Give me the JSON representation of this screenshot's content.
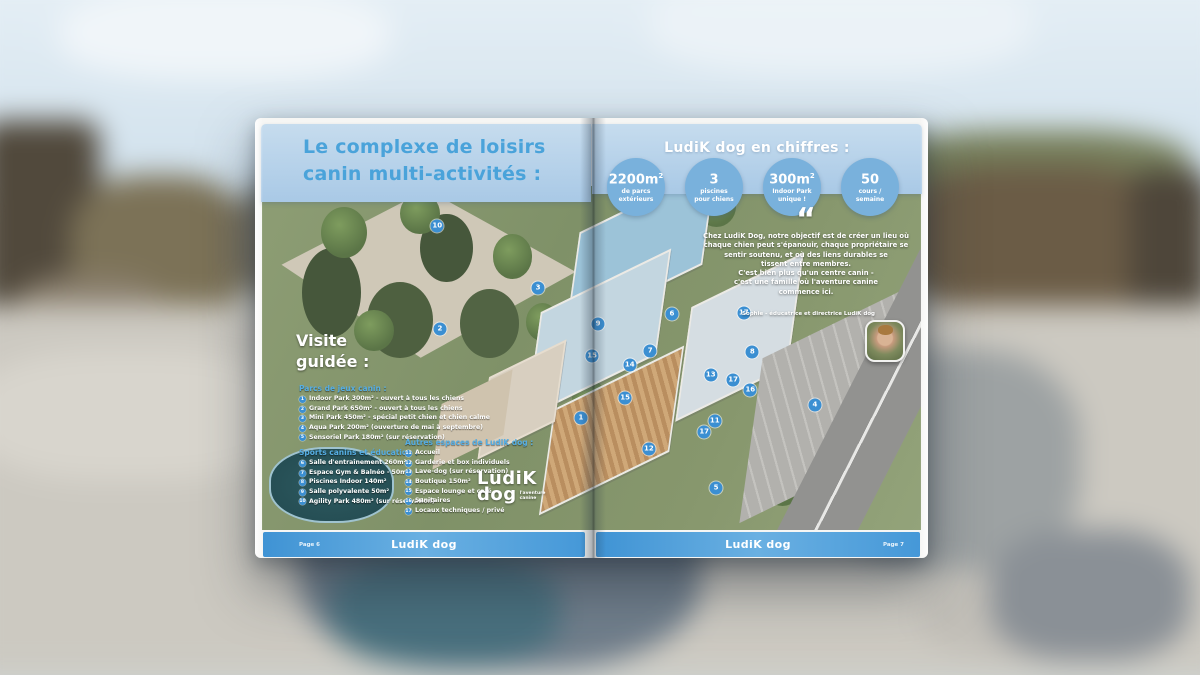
{
  "background": {
    "description": "blurred outdoor courtyard with fences and gravel ground"
  },
  "brochure": {
    "left_page": {
      "title_line1": "Le complexe de loisirs",
      "title_line2": "canin multi-activités :",
      "visite_heading_line1": "Visite",
      "visite_heading_line2": "guidée :",
      "parcs": {
        "title": "Parcs de jeux canin :",
        "items": [
          {
            "num": "1",
            "label": "Indoor Park 300m² - ouvert à tous les chiens"
          },
          {
            "num": "2",
            "label": "Grand Park 650m² - ouvert à tous les chiens"
          },
          {
            "num": "3",
            "label": "Mini Park 450m² - spécial petit chien et chien calme"
          },
          {
            "num": "4",
            "label": "Aqua Park 200m² (ouverture de mai à septembre)"
          },
          {
            "num": "5",
            "label": "Sensoriel Park 180m² (sur réservation)"
          }
        ]
      },
      "sports": {
        "title": "Sports canins et éducation :",
        "items": [
          {
            "num": "6",
            "label": "Salle d'entraînement 260m²"
          },
          {
            "num": "7",
            "label": "Espace Gym & Balnéo - 50m²"
          },
          {
            "num": "8",
            "label": "Piscines Indoor 140m²"
          },
          {
            "num": "9",
            "label": "Salle polyvalente 50m²"
          },
          {
            "num": "10",
            "label": "Agility Park 480m² (sur réservation)"
          }
        ]
      },
      "autres": {
        "title": "Autres espaces de LudiK dog :",
        "items": [
          {
            "num": "11",
            "label": "Accueil"
          },
          {
            "num": "12",
            "label": "Garderie et box individuels"
          },
          {
            "num": "13",
            "label": "Lave-dog (sur réservation)"
          },
          {
            "num": "14",
            "label": "Boutique 150m²"
          },
          {
            "num": "15",
            "label": "Espace lounge et café"
          },
          {
            "num": "16",
            "label": "Sanitaires"
          },
          {
            "num": "17",
            "label": "Locaux techniques / privé"
          }
        ]
      },
      "footer": {
        "page_label": "Page 6",
        "brand": "LudiK dog"
      }
    },
    "right_page": {
      "heading": "LudiK dog en chiffres :",
      "stats": [
        {
          "value": "2200m",
          "sup": "2",
          "label": "de parcs\nextérieurs"
        },
        {
          "value": "3",
          "sup": "",
          "label": "piscines\npour chiens"
        },
        {
          "value": "300m",
          "sup": "2",
          "label": "Indoor Park\nunique !"
        },
        {
          "value": "50",
          "sup": "",
          "label": "cours /\nsemaine"
        }
      ],
      "quote": {
        "mark": "“",
        "lines": [
          {
            "text": "Chez LudiK Dog, notre objectif est de créer un lieu où"
          },
          {
            "text": "chaque chien peut s'épanouir, chaque propriétaire se"
          },
          {
            "text": "sentir soutenu, et où des liens durables se"
          },
          {
            "text": "tissent entre membres."
          },
          {
            "text": "C'est bien plus qu'un centre canin -"
          },
          {
            "text": "c'est une famille où l'aventure canine"
          },
          {
            "text": "commence ici."
          }
        ],
        "attribution": "Sophie - éducatrice et directrice LudiK dog"
      },
      "footer": {
        "brand": "LudiK dog",
        "page_label": "Page 7"
      }
    },
    "logo": {
      "line1": "LudiK",
      "line2": "dog",
      "tagline_line1": "l'aventure",
      "tagline_line2": "canine"
    },
    "markers": [
      {
        "num": "1",
        "x": 48.4,
        "y": 67.4
      },
      {
        "num": "2",
        "x": 27.0,
        "y": 41.6
      },
      {
        "num": "3",
        "x": 41.9,
        "y": 29.7
      },
      {
        "num": "4",
        "x": 83.9,
        "y": 63.7
      },
      {
        "num": "5",
        "x": 68.9,
        "y": 87.8
      },
      {
        "num": "6",
        "x": 62.2,
        "y": 37.2
      },
      {
        "num": "7",
        "x": 58.9,
        "y": 48.0
      },
      {
        "num": "8",
        "x": 74.4,
        "y": 48.3
      },
      {
        "num": "9",
        "x": 51.0,
        "y": 40.1
      },
      {
        "num": "10",
        "x": 26.6,
        "y": 11.6
      },
      {
        "num": "11",
        "x": 68.7,
        "y": 68.3
      },
      {
        "num": "12",
        "x": 58.7,
        "y": 76.5
      },
      {
        "num": "13",
        "x": 68.1,
        "y": 54.9
      },
      {
        "num": "14",
        "x": 55.8,
        "y": 52.0
      },
      {
        "num": "15",
        "x": 50.1,
        "y": 49.4
      },
      {
        "num": "15",
        "x": 55.1,
        "y": 61.6
      },
      {
        "num": "16",
        "x": 74.1,
        "y": 59.3
      },
      {
        "num": "17",
        "x": 73.1,
        "y": 36.9
      },
      {
        "num": "17",
        "x": 71.5,
        "y": 56.4
      },
      {
        "num": "17",
        "x": 67.1,
        "y": 71.5
      }
    ]
  }
}
